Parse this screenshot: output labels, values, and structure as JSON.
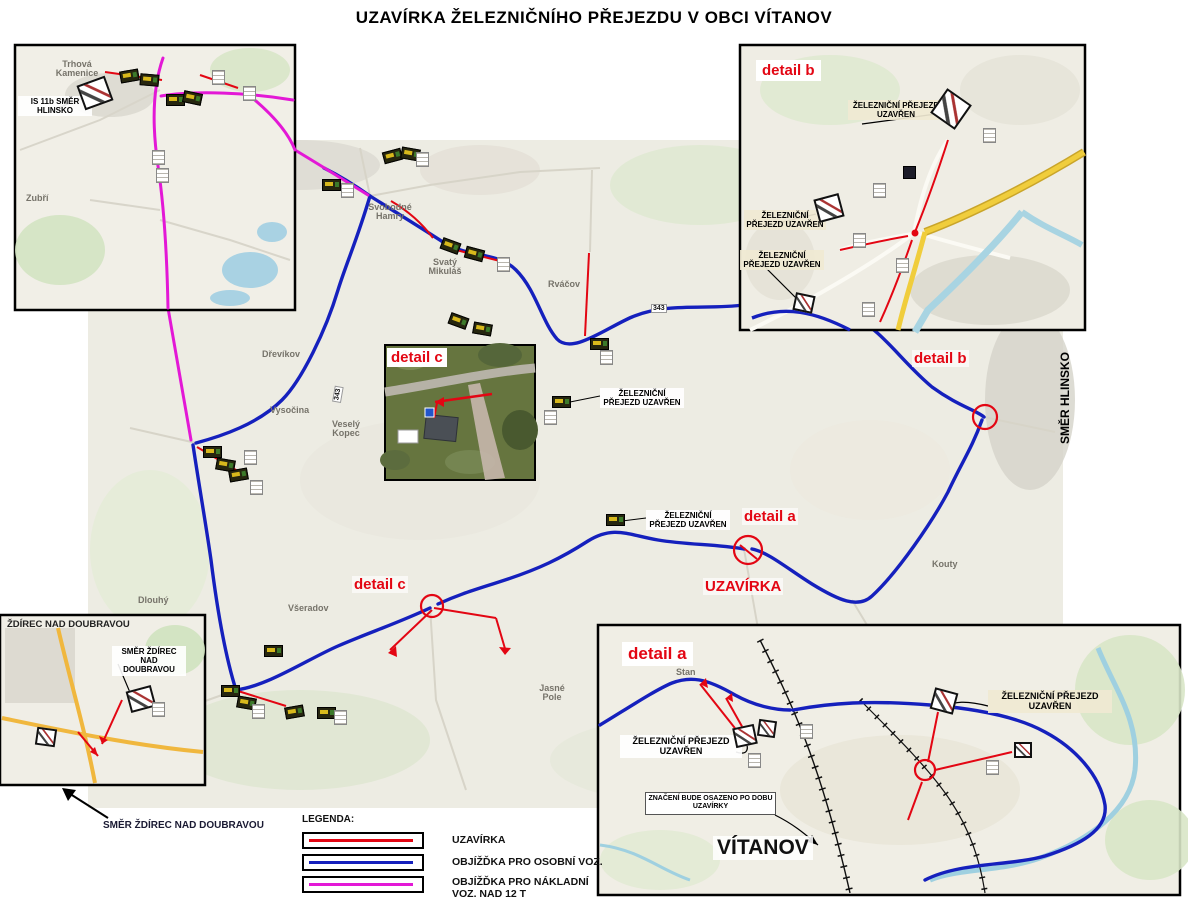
{
  "title": "UZAVÍRKA ŽELEZNIČNÍHO PŘEJEZDU V OBCI VÍTANOV",
  "colors": {
    "closure": "#e30613",
    "detour_car": "#1520bd",
    "detour_truck": "#e318d6",
    "road_yellow": "#f0cd3c"
  },
  "legend": {
    "heading": "LEGENDA:",
    "items": [
      {
        "label": "UZAVÍRKA",
        "color": "#e30613"
      },
      {
        "label": "OBJÍŽĎKA PRO OSOBNÍ VOZ.",
        "color": "#1520bd"
      },
      {
        "label": "OBJÍŽĎKA PRO NÁKLADNÍ VOZ. NAD 12 T",
        "color": "#e318d6"
      }
    ]
  },
  "directions": {
    "hlinsko": "SMĚR HLINSKO",
    "zdirec": "SMĚR ŽDÍREC NAD DOUBRAVOU"
  },
  "main_map": {
    "markers": {
      "detail_a": "detail a",
      "detail_b": "detail b",
      "detail_c": "detail c",
      "closure": "UZAVÍRKA"
    },
    "places": [
      "Dřevíkov",
      "Vysočina",
      "Veselý Kopec",
      "Svobodné Hamry",
      "Svatý Mikuláš",
      "Rváčov",
      "Všeradov",
      "Jasné Pole",
      "Kouty",
      "Dlouhý"
    ],
    "road_number": "343",
    "callouts": [
      "ŽELEZNIČNÍ PŘEJEZD UZAVŘEN",
      "ŽELEZNIČNÍ PŘEJEZD UZAVŘEN"
    ]
  },
  "insets": {
    "top_left": {
      "place": "Trhová Kamenice",
      "place2": "Zubří",
      "note": "IS 11b SMĚR HLINSKO"
    },
    "detail_b": {
      "heading": "detail b",
      "callouts": [
        "ŽELEZNIČNÍ PŘEJEZD UZAVŘEN",
        "ŽELEZNIČNÍ PŘEJEZD UZAVŘEN",
        "ŽELEZNIČNÍ PŘEJEZD UZAVŘEN"
      ]
    },
    "detail_c": {
      "heading": "detail c"
    },
    "bottom_left": {
      "heading": "ŽDÍREC NAD DOUBRAVOU",
      "note": "SMĚR ŽDÍREC NAD DOUBRAVOU"
    },
    "detail_a": {
      "heading": "detail a",
      "place": "Stan",
      "town": "VÍTANOV",
      "callout_left": "ŽELEZNIČNÍ PŘEJEZD UZAVŘEN",
      "callout_right": "ŽELEZNIČNÍ PŘEJEZD UZAVŘEN",
      "note": "ZNAČENÍ BUDE OSAZENO PO DOBU UZAVÍRKY"
    }
  }
}
